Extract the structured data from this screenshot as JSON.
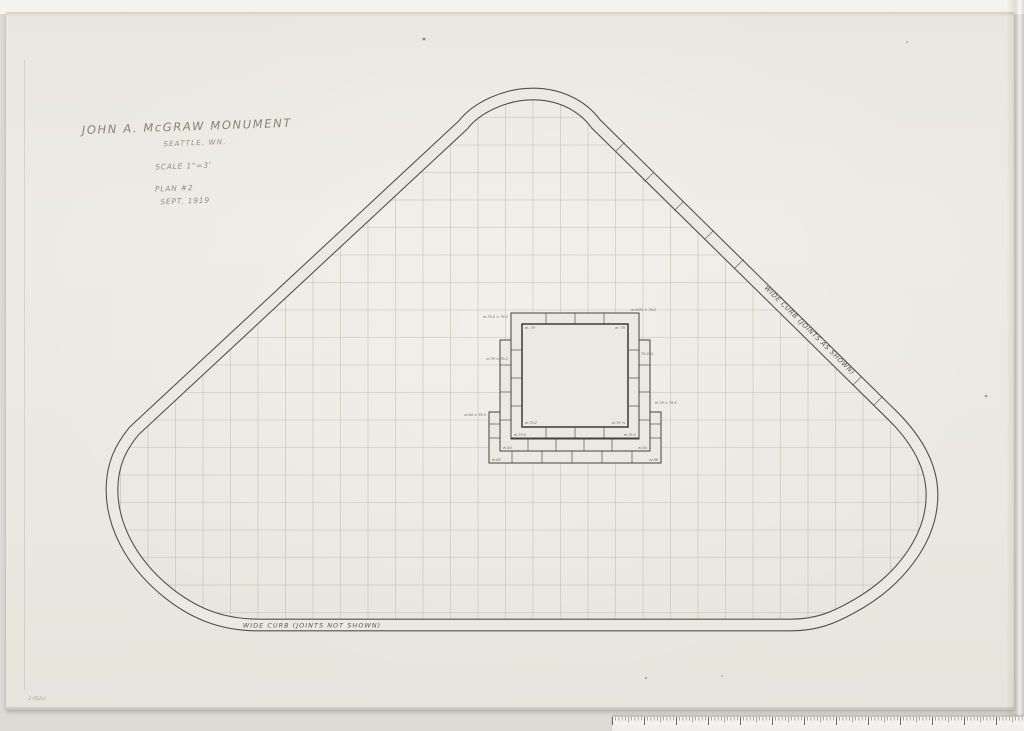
{
  "document": {
    "title": "JOHN A. McGRAW MONUMENT",
    "subtitle": "SEATTLE, WN.",
    "scale_note": "SCALE 1\"=3'",
    "plan_note": "PLAN #2",
    "date_note": "SEPT. 1919"
  },
  "labels": {
    "curb_right": "WIDE CURB (JOINTS AS SHOWN)",
    "curb_bottom": "WIDE CURB (JOINTS NOT SHOWN)",
    "corner_pencil_mark": "2-(62c)"
  },
  "colors": {
    "paper": "#ebe9e1",
    "ink": "#54504a",
    "grid": "#b8b3a6",
    "pencil_title": "#8a8373",
    "pencil_faint": "#b3ac98",
    "annotation": "#6e695c"
  },
  "grid": {
    "spacing": 27.5,
    "x_origin": 533,
    "x_min": 93,
    "x_max": 946,
    "y_origin": 612.5,
    "y_min": 90,
    "y_top": 80,
    "y_bottom": 640,
    "x_left": 90,
    "x_right": 950
  },
  "monument": {
    "annotations": [
      {
        "x": 508,
        "y": 318,
        "anchor": "end",
        "text": "el.79.5 × 79.2"
      },
      {
        "x": 525,
        "y": 329,
        "anchor": "start",
        "text": "el. 79"
      },
      {
        "x": 625,
        "y": 329,
        "anchor": "end",
        "text": "el. 79"
      },
      {
        "x": 631,
        "y": 311,
        "anchor": "start",
        "text": "el.89½ × 79.2"
      },
      {
        "x": 508,
        "y": 360,
        "anchor": "end",
        "text": "el.79 × 79.2"
      },
      {
        "x": 641,
        "y": 355,
        "anchor": "start",
        "text": "79.2 ¾"
      },
      {
        "x": 486,
        "y": 416,
        "anchor": "end",
        "text": "el.84 × 79.5"
      },
      {
        "x": 655,
        "y": 404,
        "anchor": "start",
        "text": "el.79 × 79.5"
      },
      {
        "x": 525,
        "y": 424,
        "anchor": "start",
        "text": "el.79.2"
      },
      {
        "x": 625,
        "y": 424,
        "anchor": "end",
        "text": "el.79 ¾"
      },
      {
        "x": 514,
        "y": 436,
        "anchor": "start",
        "text": "el.79.5"
      },
      {
        "x": 636,
        "y": 436,
        "anchor": "end",
        "text": "el.79.5"
      },
      {
        "x": 503,
        "y": 449,
        "anchor": "start",
        "text": "el.84"
      },
      {
        "x": 647,
        "y": 449,
        "anchor": "end",
        "text": "el.84"
      },
      {
        "x": 492,
        "y": 461,
        "anchor": "start",
        "text": "el.88"
      },
      {
        "x": 658,
        "y": 461,
        "anchor": "end",
        "text": "el.88"
      }
    ]
  },
  "ruler": {
    "width": 412,
    "height": 14,
    "minor_step": 3.2,
    "medium_every": 5,
    "major_every": 10
  }
}
